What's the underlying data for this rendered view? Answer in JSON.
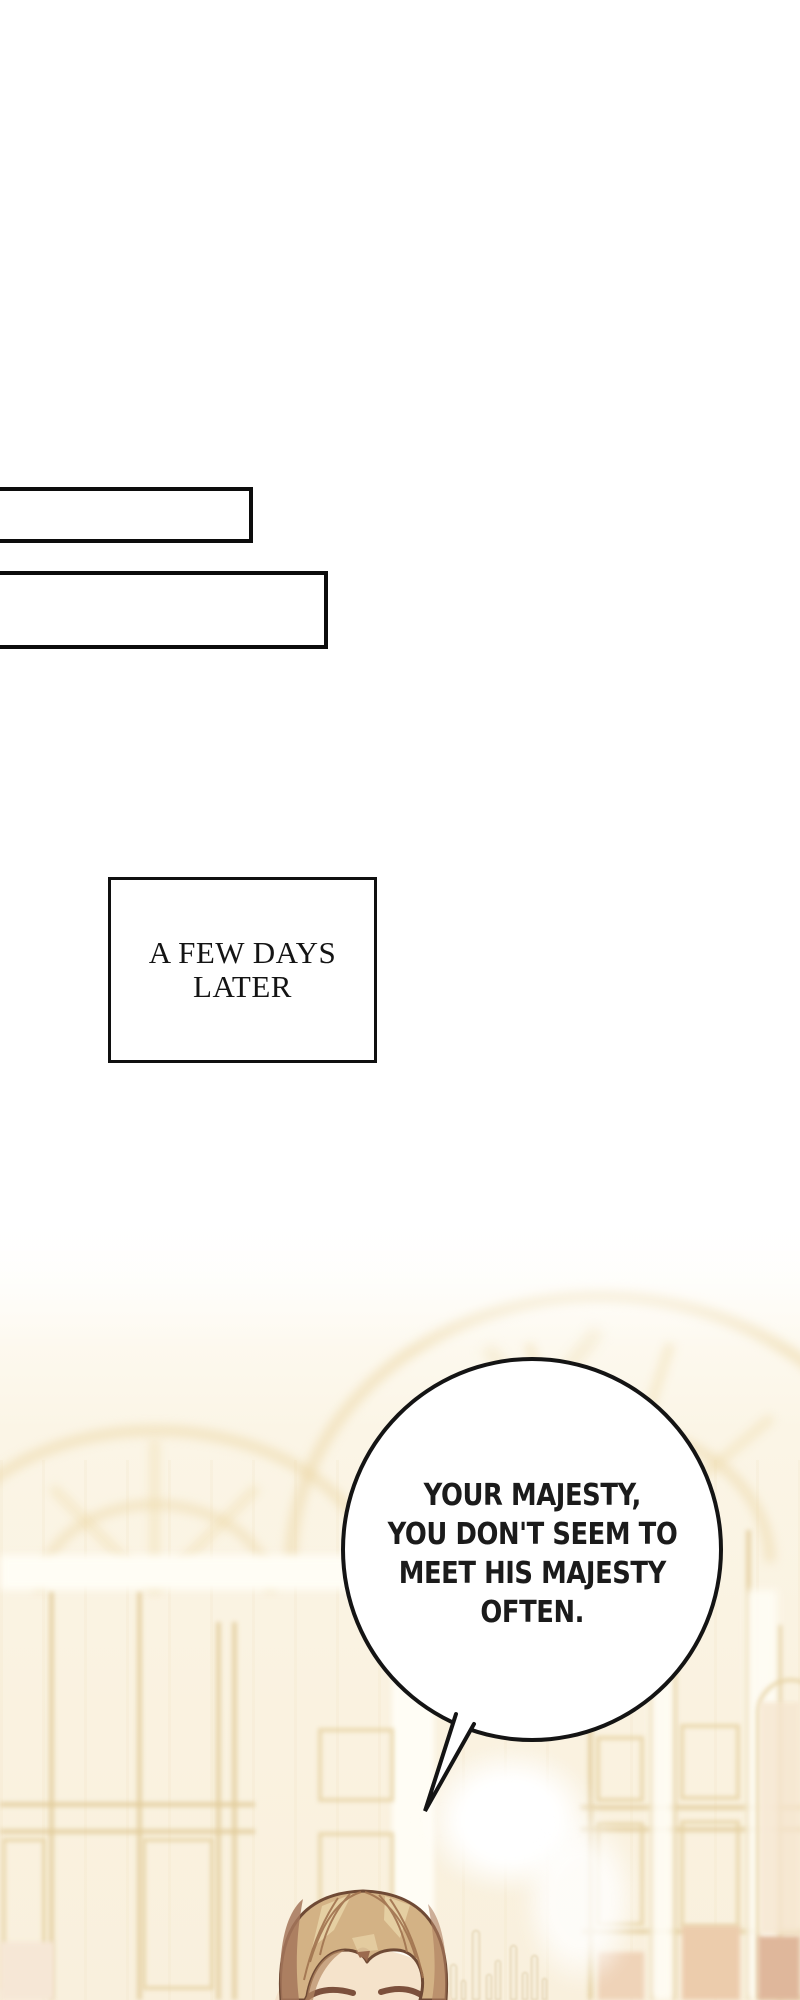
{
  "page": {
    "width": 800,
    "height": 2000,
    "background": "#ffffff",
    "ink": "#141414"
  },
  "narration_boxes": [
    {
      "text": ""
    },
    {
      "text": ""
    }
  ],
  "time_box": {
    "text": "A FEW DAYS LATER"
  },
  "speech_bubble": {
    "lines": [
      "YOUR MAJESTY,",
      "YOU DON'T SEEM TO",
      "MEET HIS MAJESTY",
      "OFTEN."
    ]
  },
  "scene": {
    "palette": {
      "cream": "#fbf4e4",
      "gold_trim": "#e6d0a0",
      "peach_panel": "#ecccac",
      "hair": "#d3b285",
      "hair_highlight": "#e7d1a5",
      "hair_shadow": "#a5755a",
      "hair_outline": "#6f4a35",
      "skin": "#f5e3cb",
      "eyebrow": "#7c503c"
    }
  }
}
